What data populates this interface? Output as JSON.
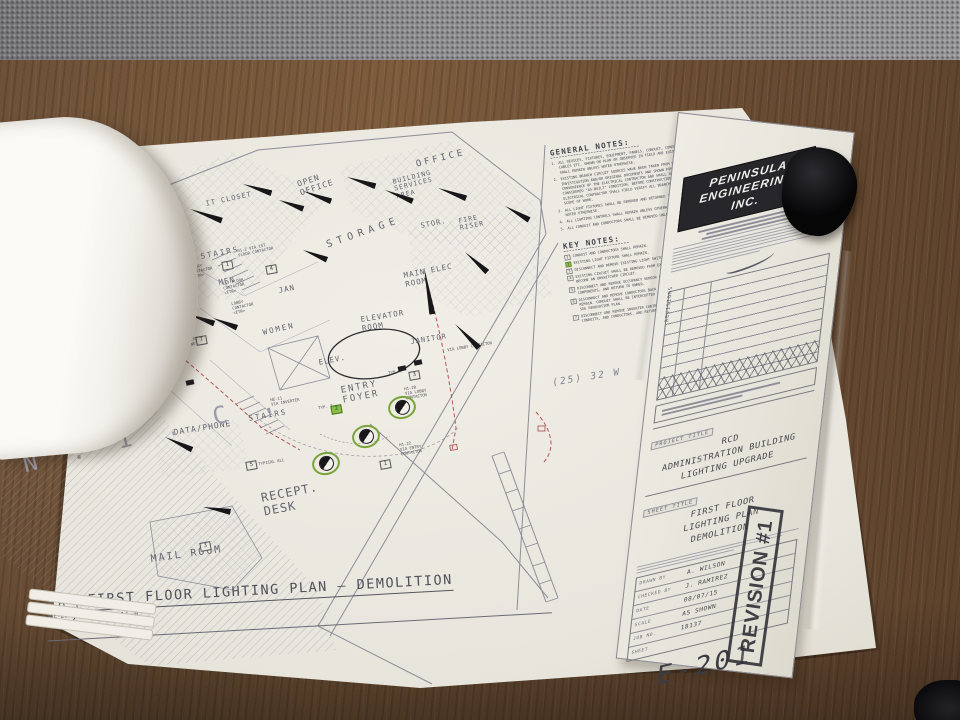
{
  "sheet": {
    "notes": {
      "general": {
        "title": "GENERAL NOTES:",
        "items": [
          "ALL DEVICES, FIXTURES, EQUIPMENT, PANELS, CONDUIT, CONDUCTORS AND CABLES ETC. SHOWN ON PLAN OR OBSERVED IN FIELD ARE EXISTING AND SHALL REMAIN UNLESS NOTED OTHERWISE.",
          "EXISTING BRANCH CIRCUIT SOURCES HAVE BEEN TAKEN FROM FIELD INVESTIGATION AND/OR ORIGINAL DOCUMENTS AND SHOWN FOR THE CONVENIENCE OF THE ELECTRICAL CONTRACTOR AND SHALL NOT BE CONSIDERED \"AS-BUILT\" CONDITION. BEFORE CONSTRUCTION BEGINS, ELECTRICAL CONTRACTOR SHALL FIELD VERIFY ALL BRANCH CIRCUITS WITHIN SCOPE OF WORK.",
          "ALL LIGHT FIXTURES SHALL BE REMOVED AND RETURNED TO OWNER, UNLESS NOTED OTHERWISE.",
          "ALL LIGHTING CONTROLS SHALL REMAIN UNLESS OTHERWISE NOTED.",
          "ALL CONDUIT AND CONDUCTORS SHALL BE REMOVED UNLESS OTHERWISE NOTED."
        ]
      },
      "key": {
        "title": "KEY NOTES:",
        "items": [
          {
            "text": "CONDUIT AND CONDUCTORS SHALL REMAIN.",
            "highlight": false
          },
          {
            "text": "EXISTING LIGHT FIXTURE SHALL REMAIN.",
            "highlight": true
          },
          {
            "text": "DISCONNECT AND REMOVE EXISTING LIGHT SWITCH.",
            "highlight": false
          },
          {
            "text": "EXISTING CIRCUIT SHALL BE REMOVED FROM EXISTING CONTACTOR TO BECOME AN UNSWITCHED CIRCUIT.",
            "highlight": false
          },
          {
            "text": "DISCONNECT AND REMOVE OCCUPANCY SENSOR AND ALL ASSOCIATED COMPONENTS, AND RETURN TO OWNER.",
            "highlight": false
          },
          {
            "text": "DISCONNECT AND REMOVE CONDUCTORS BACK TO SOURCE. CONDUIT SHALL REMAIN. CONDUIT SHALL BE INTERCEPTED TO PULL NEW INVERTER CIRCUIT. SEE RENOVATION PLAN.",
            "highlight": false
          },
          {
            "text": "DISCONNECT AND REMOVE INVERTER CABINET, AND ALL ASSOCIATED CONDUITS, AND CONDUCTORS, AND RETURN TO OWNER.",
            "highlight": false
          }
        ]
      }
    },
    "pencil_note": "(25) 32 W",
    "plan": {
      "rooms": [
        {
          "label": "OFFICE",
          "x": 415,
          "y": 160,
          "rot": -14,
          "fs": 9,
          "ls": 3
        },
        {
          "label": "BUILDING\nSERVICES\nAREA",
          "x": 392,
          "y": 179,
          "rot": -14,
          "fs": 6.5,
          "ls": 1
        },
        {
          "label": "OPEN\nOFFICE",
          "x": 296,
          "y": 180,
          "rot": -18,
          "fs": 8,
          "ls": 1
        },
        {
          "label": "IT CLOSET",
          "x": 205,
          "y": 200,
          "rot": -12,
          "fs": 7,
          "ls": 1
        },
        {
          "label": "CONFERENCE\nROOM",
          "x": 110,
          "y": 224,
          "rot": -15,
          "fs": 8,
          "ls": 1
        },
        {
          "label": "STORAGE",
          "x": 325,
          "y": 240,
          "rot": -19,
          "fs": 10,
          "ls": 5
        },
        {
          "label": "STOR.",
          "x": 420,
          "y": 222,
          "rot": -11,
          "fs": 7,
          "ls": 1
        },
        {
          "label": "FIRE\nRISER",
          "x": 458,
          "y": 218,
          "rot": -11,
          "fs": 6.5,
          "ls": 1
        },
        {
          "label": "MAIN ELEC\nROOM",
          "x": 403,
          "y": 272,
          "rot": -11,
          "fs": 7.5,
          "ls": 1
        },
        {
          "label": "STAIRS",
          "x": 200,
          "y": 253,
          "rot": -11,
          "fs": 7.5,
          "ls": 2
        },
        {
          "label": "MEN",
          "x": 218,
          "y": 279,
          "rot": -11,
          "fs": 7.5,
          "ls": 1
        },
        {
          "label": "JAN",
          "x": 278,
          "y": 287,
          "rot": -11,
          "fs": 7.5,
          "ls": 1
        },
        {
          "label": "MECH",
          "x": 160,
          "y": 315,
          "rot": -13,
          "fs": 7.5,
          "ls": 1
        },
        {
          "label": "WOMEN",
          "x": 262,
          "y": 329,
          "rot": -13,
          "fs": 7.5,
          "ls": 2
        },
        {
          "label": "STORAGE",
          "x": 86,
          "y": 326,
          "rot": -17,
          "fs": 8,
          "ls": 2
        },
        {
          "label": "ELEV.",
          "x": 318,
          "y": 359,
          "rot": -11,
          "fs": 7.5,
          "ls": 1
        },
        {
          "label": "ELEVATOR\nROOM",
          "x": 360,
          "y": 316,
          "rot": -9,
          "fs": 7.5,
          "ls": 1
        },
        {
          "label": "JANITOR",
          "x": 410,
          "y": 338,
          "rot": -9,
          "fs": 7,
          "ls": 1
        },
        {
          "label": "ENTRY\nFOYER",
          "x": 340,
          "y": 386,
          "rot": -11,
          "fs": 9,
          "ls": 2
        },
        {
          "label": "STAIRS",
          "x": 248,
          "y": 415,
          "rot": -10,
          "fs": 7.5,
          "ls": 2
        },
        {
          "label": "DATA/PHONE",
          "x": 173,
          "y": 428,
          "rot": -9,
          "fs": 8,
          "ls": 1
        },
        {
          "label": "N . I . C .",
          "x": 20,
          "y": 452,
          "rot": -14,
          "fs": 24,
          "ls": 10,
          "cls": "nic"
        },
        {
          "label": "RECEPT.\nDESK",
          "x": 260,
          "y": 492,
          "rot": -11,
          "fs": 12,
          "ls": 1
        },
        {
          "label": "MAIL ROOM",
          "x": 150,
          "y": 554,
          "rot": -8,
          "fs": 10,
          "ls": 2
        }
      ],
      "annotations": [
        {
          "text": "PANEL 'H1'\n<ETR>",
          "x": 150,
          "y": 283,
          "rot": -12
        },
        {
          "text": "ENTRY\nCONTACTOR\n<ETR>",
          "x": 190,
          "y": 266,
          "rot": -12
        },
        {
          "text": "1ST FLOOR\nCONTACTOR\n<ETR>",
          "x": 222,
          "y": 282,
          "rot": -12
        },
        {
          "text": "LOBBY\nCONTACTOR\n<ETR>",
          "x": 231,
          "y": 302,
          "rot": -12
        },
        {
          "text": "H1-2 VIA 1ST\nFLOOR CONTACTOR",
          "x": 237,
          "y": 249,
          "rot": -12
        },
        {
          "text": "INVERTER\nCABINET",
          "x": 180,
          "y": 340,
          "rot": -12
        },
        {
          "text": "HE-11\nVIA INVERTER",
          "x": 270,
          "y": 398,
          "rot": -10
        },
        {
          "text": "VIA LOBBY CONTACTOR",
          "x": 447,
          "y": 348,
          "rot": -9
        },
        {
          "text": "H1-20\nVIA LOBBY\nCONTACTOR",
          "x": 404,
          "y": 387,
          "rot": -9
        },
        {
          "text": "H1-22\nVIA ENTRY\nCONTACTOR",
          "x": 399,
          "y": 443,
          "rot": -9
        },
        {
          "text": "TYPICAL ALL",
          "x": 258,
          "y": 462,
          "rot": -9
        },
        {
          "text": "TYP. 3",
          "x": 318,
          "y": 406,
          "rot": -9
        },
        {
          "text": "TYP. 2",
          "x": 388,
          "y": 371,
          "rot": -9
        }
      ],
      "keynote_tags": [
        {
          "n": "7",
          "x": 196,
          "y": 336
        },
        {
          "n": "1",
          "x": 222,
          "y": 261
        },
        {
          "n": "4",
          "x": 266,
          "y": 265
        },
        {
          "n": "5",
          "x": 246,
          "y": 461
        },
        {
          "n": "3",
          "x": 200,
          "y": 542
        },
        {
          "n": "1",
          "x": 380,
          "y": 460
        },
        {
          "n": "2",
          "x": 331,
          "y": 405,
          "g": true
        },
        {
          "n": "3",
          "x": 409,
          "y": 371
        }
      ],
      "flags": [
        [
          133,
          214,
          22,
          34
        ],
        [
          190,
          206,
          20,
          34
        ],
        [
          243,
          181,
          18,
          30
        ],
        [
          303,
          188,
          20,
          30
        ],
        [
          347,
          174,
          18,
          30
        ],
        [
          385,
          187,
          22,
          30
        ],
        [
          438,
          185,
          20,
          30
        ],
        [
          505,
          203,
          30,
          28
        ],
        [
          465,
          249,
          42,
          30
        ],
        [
          75,
          247,
          20,
          30
        ],
        [
          100,
          347,
          28,
          30
        ],
        [
          160,
          308,
          22,
          28
        ],
        [
          188,
          311,
          20,
          28
        ],
        [
          213,
          315,
          22,
          26
        ],
        [
          279,
          197,
          20,
          26
        ],
        [
          165,
          434,
          25,
          30
        ],
        [
          203,
          504,
          10,
          28
        ],
        [
          455,
          321,
          45,
          34
        ],
        [
          424,
          264,
          80,
          48
        ],
        [
          303,
          247,
          22,
          26
        ]
      ],
      "green_fixtures": [
        [
          352,
          425
        ],
        [
          312,
          452
        ],
        [
          388,
          396
        ]
      ],
      "dark_marks": [
        [
          398,
          366
        ],
        [
          414,
          360
        ],
        [
          186,
          380
        ]
      ]
    },
    "view_title": {
      "bubble_top": "A",
      "bubble_bottom": "E-201",
      "title": "FIRST FLOOR LIGHTING PLAN  —  DEMOLITION",
      "scale": "1/4\" = 1'-0\""
    },
    "title_block": {
      "firm_lines": [
        "PENINSULA",
        "ENGINEERING",
        "INC."
      ],
      "revisions_label": "REVISIONS",
      "project_title_label": "PROJECT TITLE",
      "project_title_lines": [
        "RCD",
        "ADMINISTRATION BUILDING",
        "LIGHTING UPGRADE"
      ],
      "sheet_title_label": "SHEET TITLE",
      "sheet_title_lines": [
        "FIRST FLOOR",
        "LIGHTING PLAN",
        "DEMOLITION"
      ],
      "fields": [
        {
          "label": "DRAWN BY",
          "value": "A. WILSON"
        },
        {
          "label": "CHECKED BY",
          "value": "J. RAMIREZ"
        },
        {
          "label": "DATE",
          "value": "08/07/15"
        },
        {
          "label": "SCALE",
          "value": "AS SHOWN"
        },
        {
          "label": "JOB NO.",
          "value": "18137"
        },
        {
          "label": "SHEET",
          "value": ""
        }
      ],
      "sheet_number": "E-201",
      "stamp": "REVISION #1"
    }
  }
}
